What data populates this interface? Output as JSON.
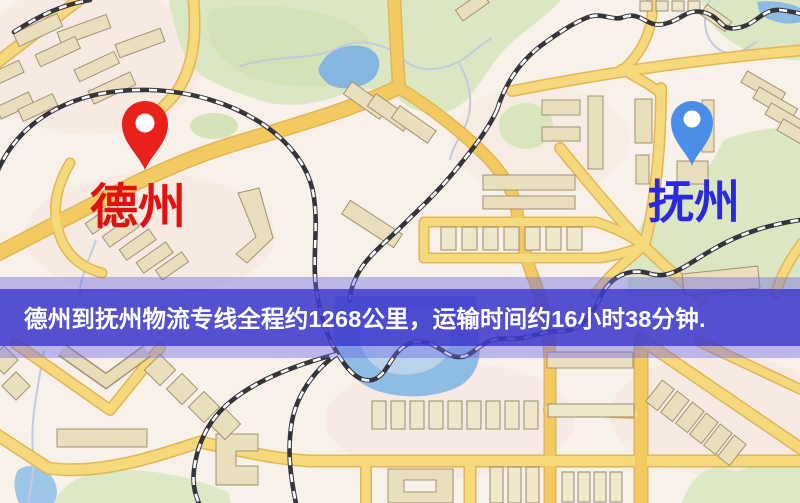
{
  "map": {
    "origin": {
      "name": "德州",
      "pin_color": "#ea211a",
      "label_color": "#e01111"
    },
    "destination": {
      "name": "抚州",
      "pin_color": "#4a8ee9",
      "label_color": "#2b28dd"
    },
    "banner": {
      "text": "德州到抚州物流专线全程约1268公里，运输时间约16小时38分钟.",
      "distance": "约1268公里",
      "duration": "约16小时38分钟",
      "text_color": "#ffffff"
    }
  }
}
